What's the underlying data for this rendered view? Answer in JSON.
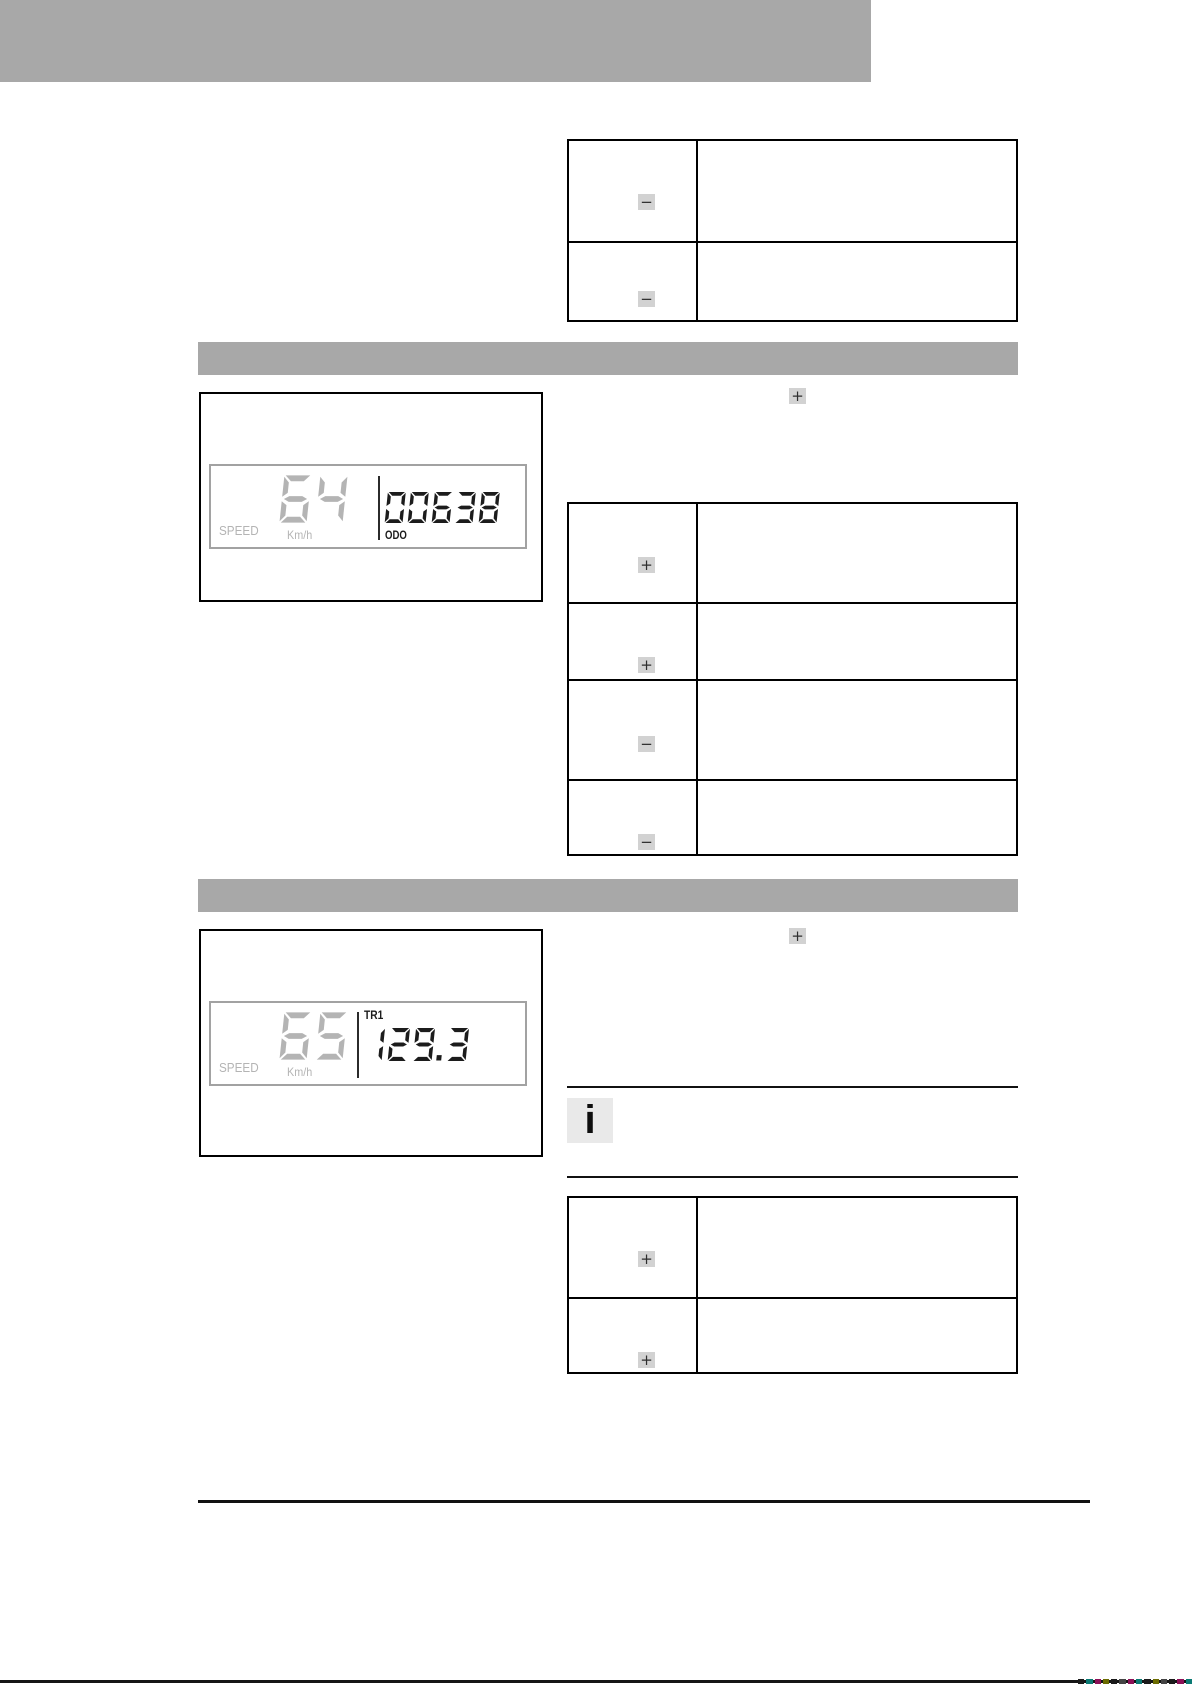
{
  "theme": {
    "gray_block": "#a8a8a8",
    "chip_bg": "#d2d2d2",
    "chip_fg": "#2e2e2e",
    "info_bg": "#e9e9e9",
    "lcd_gray": "#b4b4b4",
    "lcd_dark": "#1c1c1c",
    "line": "#000000"
  },
  "icons": {
    "plus_glyph": "+",
    "minus_glyph": "−",
    "info_glyph": "i"
  },
  "lcd1": {
    "speed_value": "64",
    "speed_label": "SPEED",
    "speed_unit": "Km/h",
    "odo_value": "00638",
    "odo_label": "ODO"
  },
  "lcd2": {
    "speed_value": "65",
    "speed_label": "SPEED",
    "speed_unit": "Km/h",
    "trip_label": "TR1",
    "trip_value": "129.3"
  },
  "tables": {
    "table1": {
      "rows": [
        {
          "icon": "minus"
        },
        {
          "icon": "minus"
        }
      ]
    },
    "table2": {
      "rows": [
        {
          "icon": "plus"
        },
        {
          "icon": "plus"
        },
        {
          "icon": "minus"
        },
        {
          "icon": "minus"
        }
      ]
    },
    "table3": {
      "rows": [
        {
          "icon": "plus"
        },
        {
          "icon": "plus"
        }
      ]
    }
  },
  "inline_buttons": {
    "section1": "plus",
    "section2": "plus"
  },
  "print_marks_colors": [
    "#1a1a1a",
    "#0a7a74",
    "#8c1057",
    "#6b6b00",
    "#1a1a1a",
    "#444444",
    "#8c1057",
    "#0a7a74",
    "#1a1a1a",
    "#6b6b00",
    "#444444",
    "#1a1a1a",
    "#8c1057",
    "#0a7a74"
  ]
}
